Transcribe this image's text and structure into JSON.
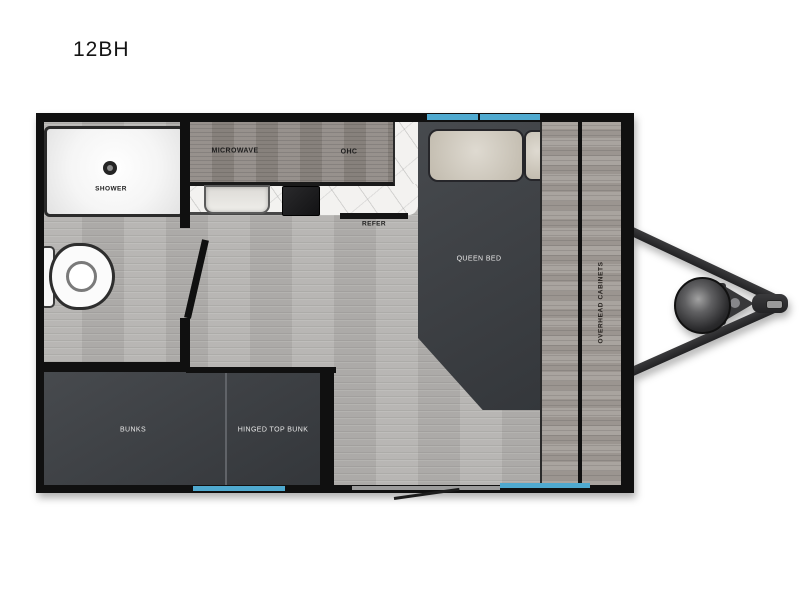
{
  "title": "12BH",
  "labels": {
    "shower": "SHOWER",
    "microwave": "MICROWAVE",
    "ohc": "OHC",
    "refer": "REFER",
    "queen_bed": "QUEEN BED",
    "overhead_cabinets": "OVERHEAD CABINETS",
    "bunks": "BUNKS",
    "hinged_top_bunk": "HINGED TOP BUNK"
  },
  "colors": {
    "window_accent": "#4fa9cf",
    "wall": "#101010",
    "furniture_dark": "#3e4145",
    "floor_gray": "#b4b2af",
    "cabinet_wood": "#8f8984",
    "counter_marble": "#f3f2f0",
    "pillow_beige": "#cdc6b8"
  }
}
